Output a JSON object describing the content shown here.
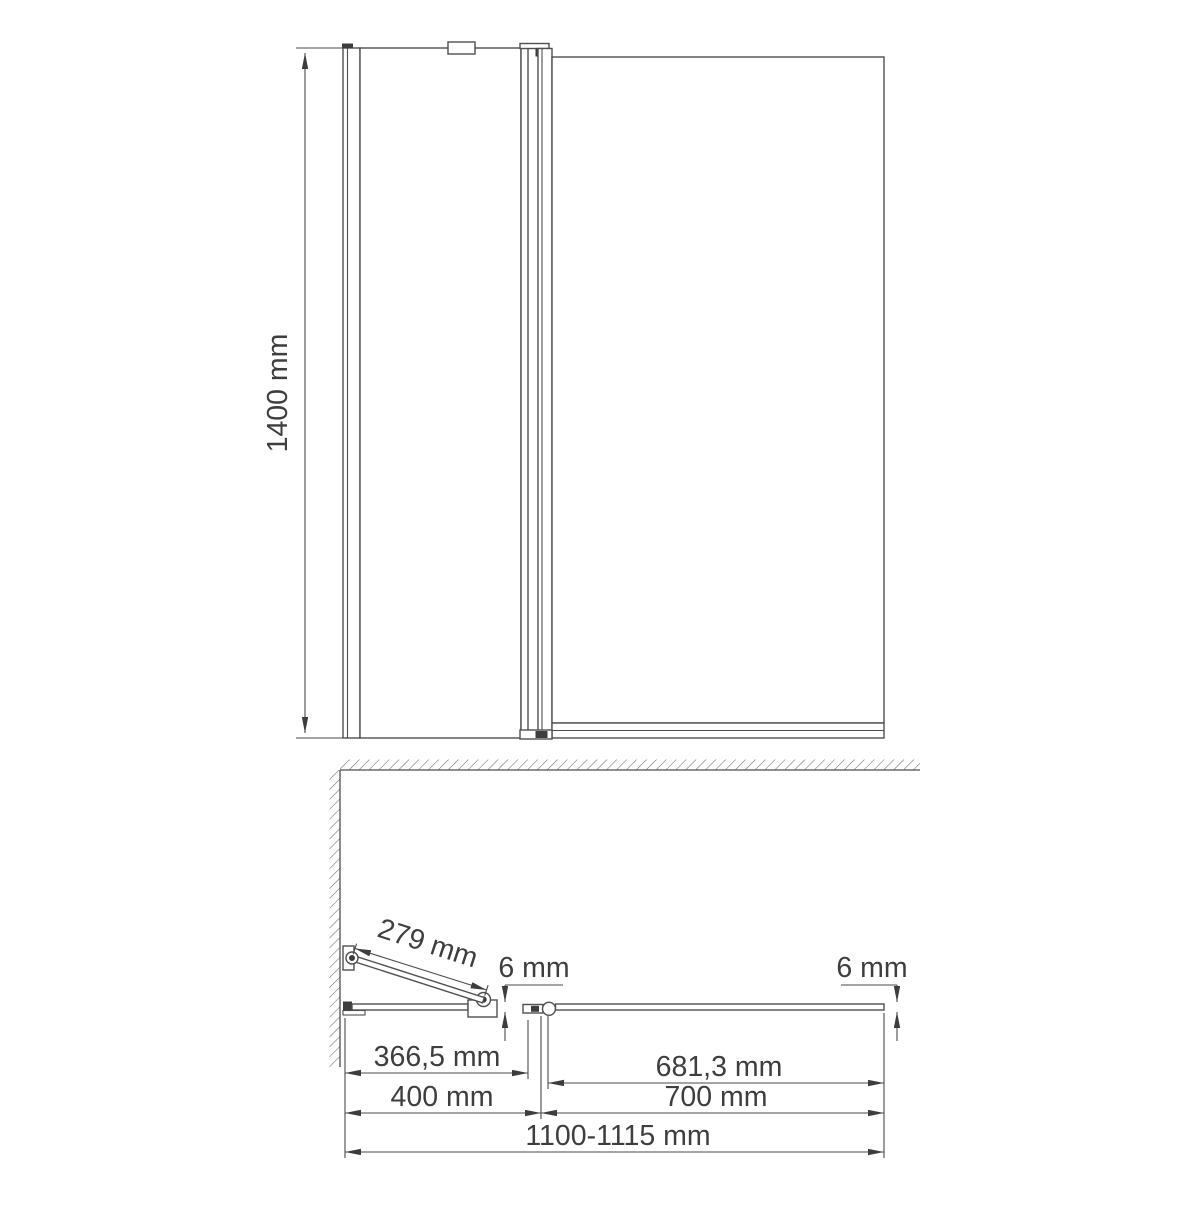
{
  "drawing": {
    "type": "shower-bath-screen technical drawing, front elevation and plan view",
    "colors": {
      "line": "#4f4f4f",
      "dark_fill": "#3d3d3d",
      "text": "#3e3e3e",
      "background": "#ffffff"
    },
    "front_view": {
      "height_label": "1400 mm"
    },
    "plan_view": {
      "open_door_length_label": "279 mm",
      "door_glass_thickness_label": "6 mm",
      "fixed_glass_thickness_label": "6 mm",
      "door_glass_width_label": "366,5 mm",
      "door_section_width_label": "400 mm",
      "fixed_glass_width_label": "681,3 mm",
      "fixed_section_width_label": "700 mm",
      "total_width_label": "1100-1115 mm"
    }
  }
}
